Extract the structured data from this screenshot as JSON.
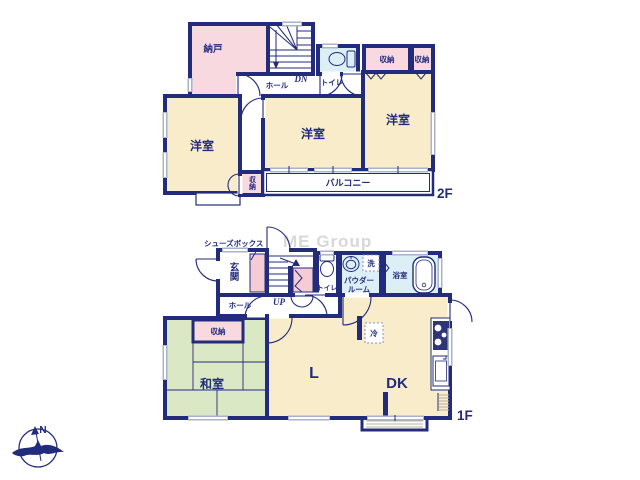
{
  "watermark": "ME Group",
  "compass": {
    "north": "N"
  },
  "palette": {
    "wall_navy": "#232b7c",
    "room_cream": "#f8ecca",
    "room_pink": "#f8d9e0",
    "room_blue": "#dceef6",
    "tatami_green": "#dbe8c6",
    "window_gray": "#a9b3c9",
    "watermark_gray": "#d8d8d8"
  },
  "f2": {
    "floor_label": "2F",
    "stairs": {
      "down": "DN"
    },
    "rooms": {
      "nando": "納戸",
      "hall": "ホール",
      "toilet": "トイレ",
      "closet_a": "収納",
      "closet_b": "収納",
      "bedroom_left": "洋室",
      "bedroom_center": "洋室",
      "bedroom_right": "洋室",
      "closet_small": "収納",
      "balcony": "バルコニー"
    }
  },
  "f1": {
    "floor_label": "1F",
    "stairs": {
      "up": "UP"
    },
    "rooms": {
      "shoes_box": "シューズボックス",
      "entrance": "玄関",
      "hall": "ホール",
      "toilet": "トイレ",
      "washer": "洗",
      "powder_line1": "パウダー",
      "powder_line2": "ルーム",
      "bath": "浴室",
      "closet": "収納",
      "japanese_room": "和室",
      "living": "L",
      "dining_kitchen": "DK",
      "fridge": "冷"
    }
  }
}
